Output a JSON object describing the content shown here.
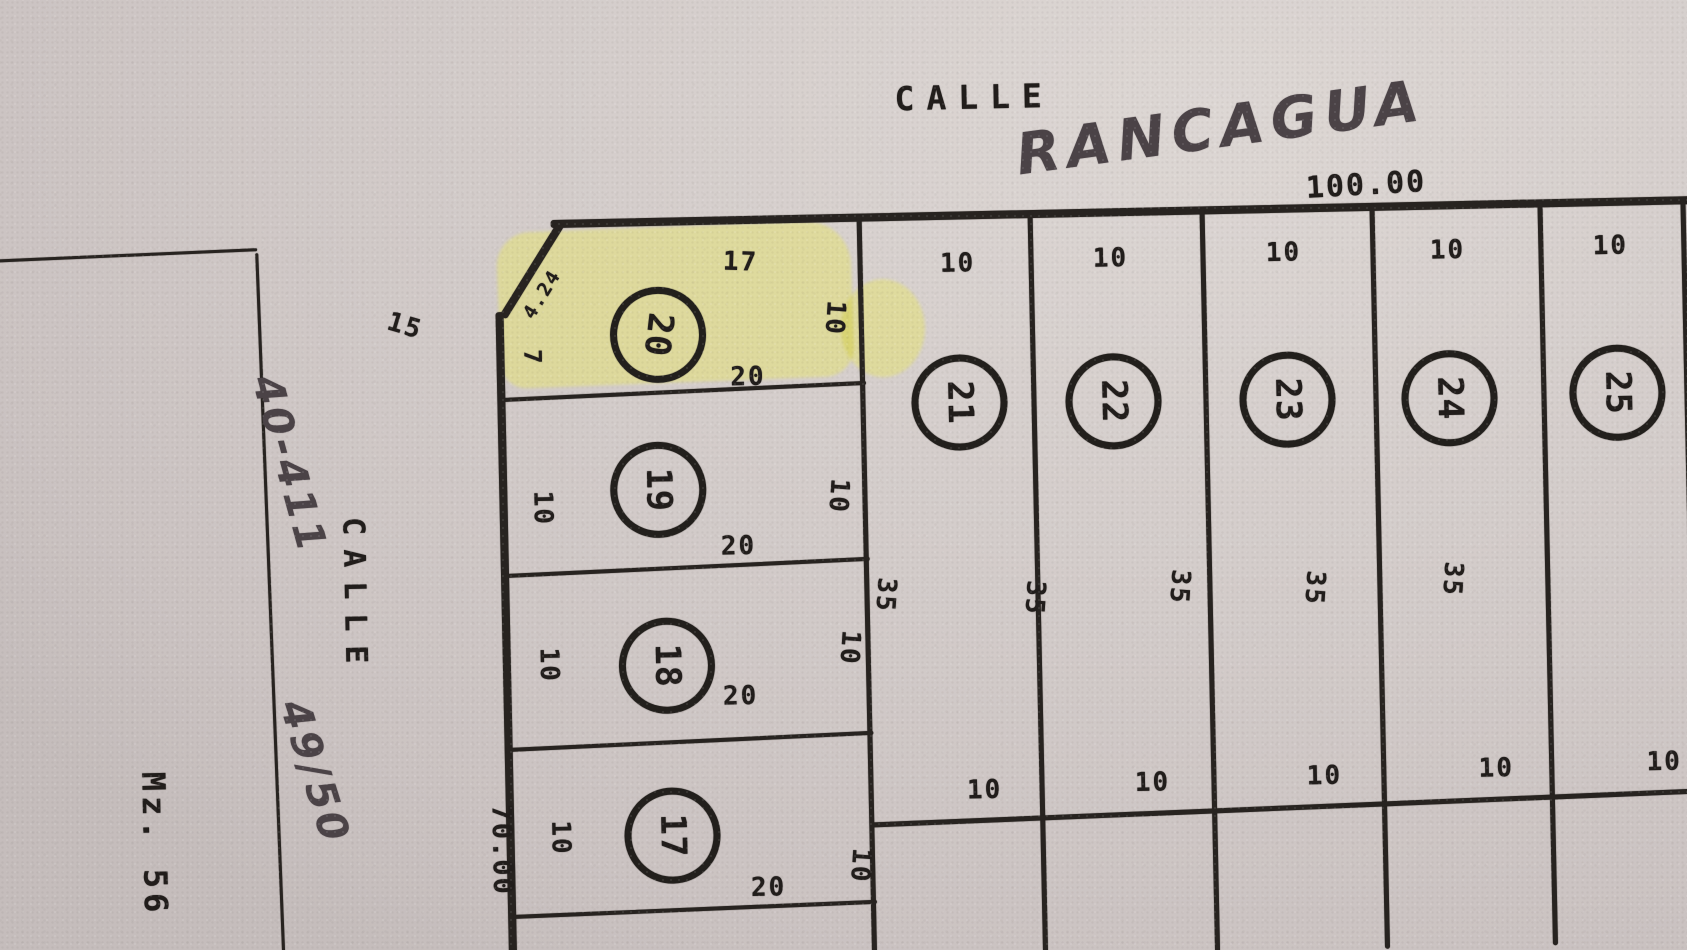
{
  "streets": {
    "top": {
      "printed": "CALLE",
      "handwritten": "RANCAGUA",
      "frontage": "100.00"
    },
    "left": {
      "printed": "CALLE"
    }
  },
  "left_block": {
    "label": "Mz. 56"
  },
  "main_block": {
    "depth_left": "70.00",
    "upper_left_dim": "15"
  },
  "notes": {
    "upper": "40-411",
    "lower": "49/50"
  },
  "lots": {
    "l17": {
      "number": "17",
      "left": "10",
      "right": "10",
      "bottom": "20"
    },
    "l18": {
      "number": "18",
      "left": "10",
      "right": "10",
      "bottom": "20"
    },
    "l19": {
      "number": "19",
      "left": "10",
      "right": "10",
      "bottom": "20"
    },
    "l20": {
      "number": "20",
      "top": "17",
      "chamfer": "4.24",
      "left": "7",
      "right": "10",
      "bottom": "20"
    },
    "l21": {
      "number": "21",
      "top": "10",
      "side": "35"
    },
    "l22": {
      "number": "22",
      "top": "10",
      "side": "35"
    },
    "l23": {
      "number": "23",
      "top": "10",
      "side": "35"
    },
    "l24": {
      "number": "24",
      "top": "10",
      "side": "35"
    },
    "l25": {
      "number": "25",
      "top": "10",
      "side": "35"
    }
  },
  "back_row_dims": [
    "10",
    "10",
    "10",
    "10",
    "10"
  ],
  "colors": {
    "highlight": "#e3e080",
    "ink": "#211d1b",
    "pen": "#4b4347",
    "paper": "#d4cdcb"
  }
}
